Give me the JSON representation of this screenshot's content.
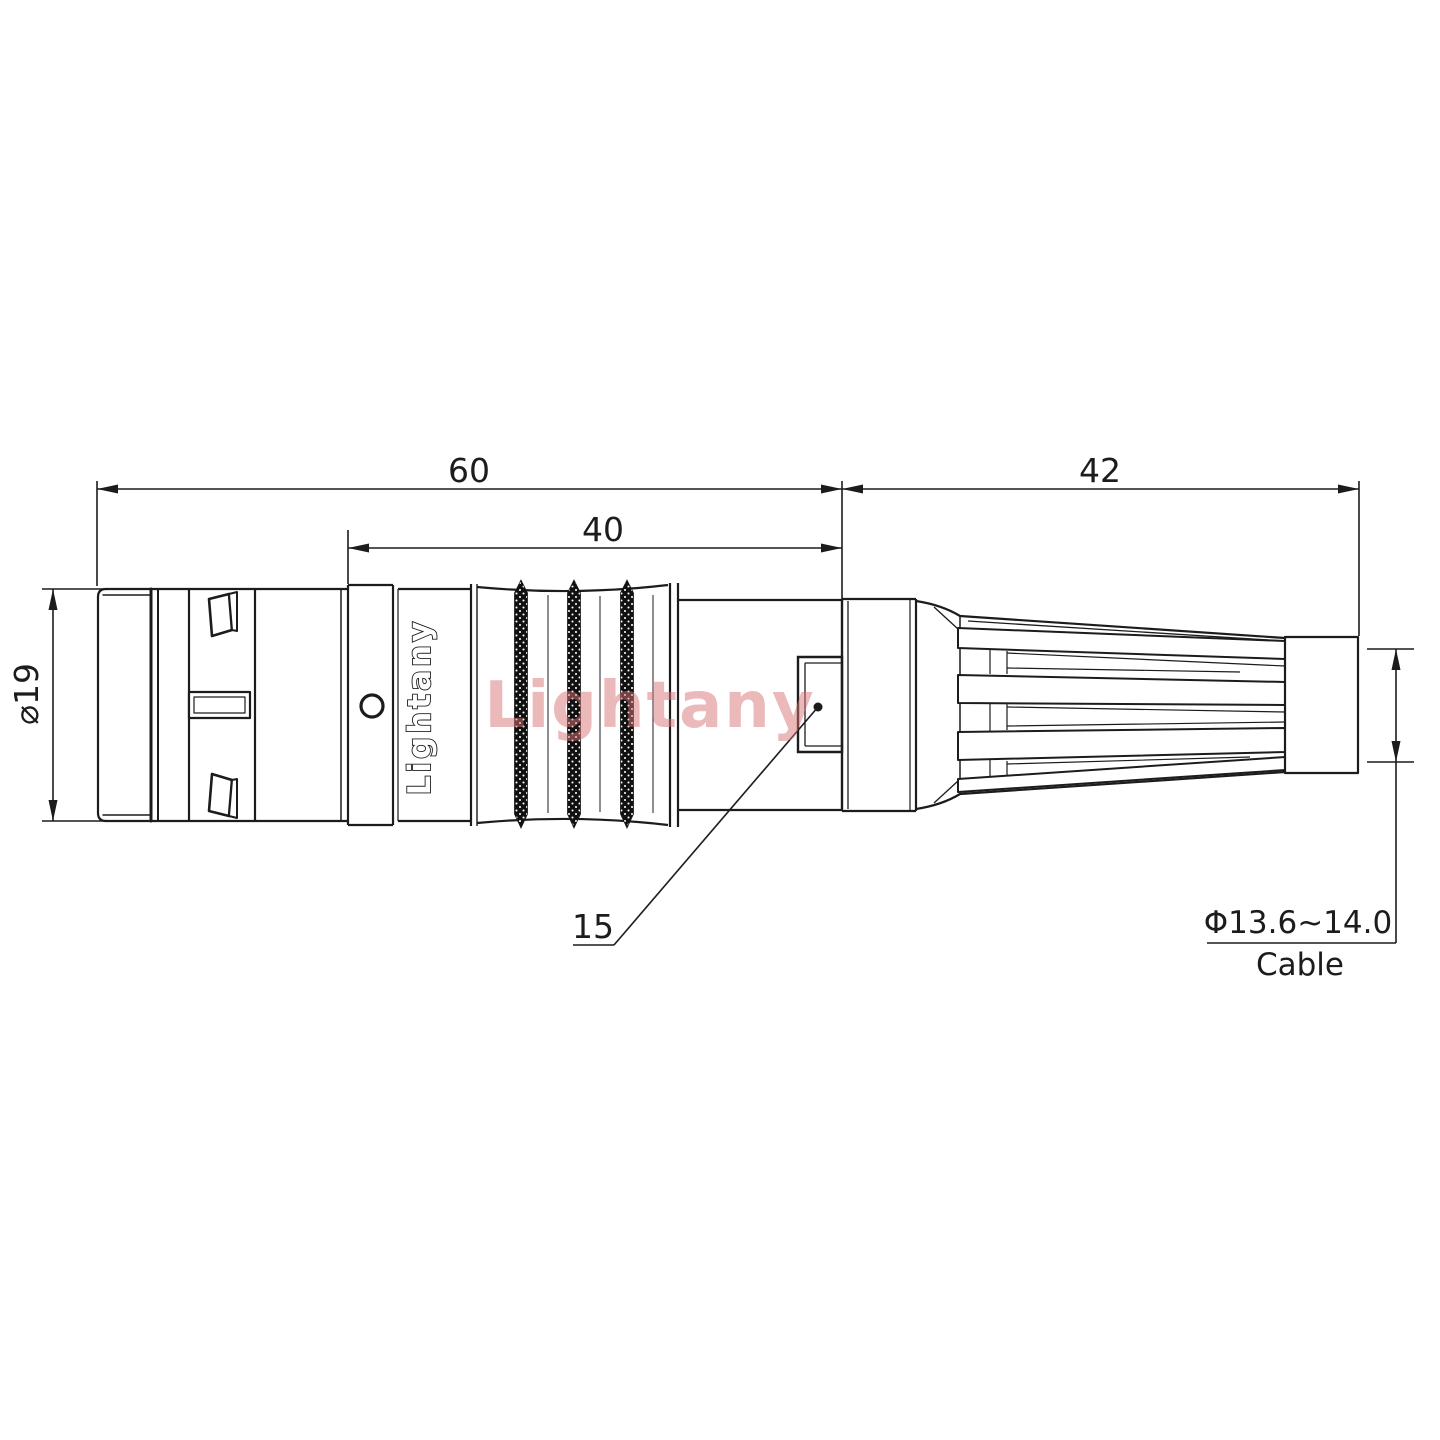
{
  "drawing": {
    "kind": "connector-technical-drawing",
    "dimensions": {
      "total_length": "60",
      "mid_length": "40",
      "boot_length": "42",
      "body_diameter": "⌀19",
      "leader_ref": "15",
      "cable_diameter": "Φ13.6~14.0",
      "cable_label": "Cable"
    },
    "branding": {
      "engraving": "Lightany",
      "watermark": "Lightany"
    },
    "colors": {
      "line": "#1c1c1c",
      "watermark": "#d97575",
      "knurl_fill": "#111111"
    }
  }
}
